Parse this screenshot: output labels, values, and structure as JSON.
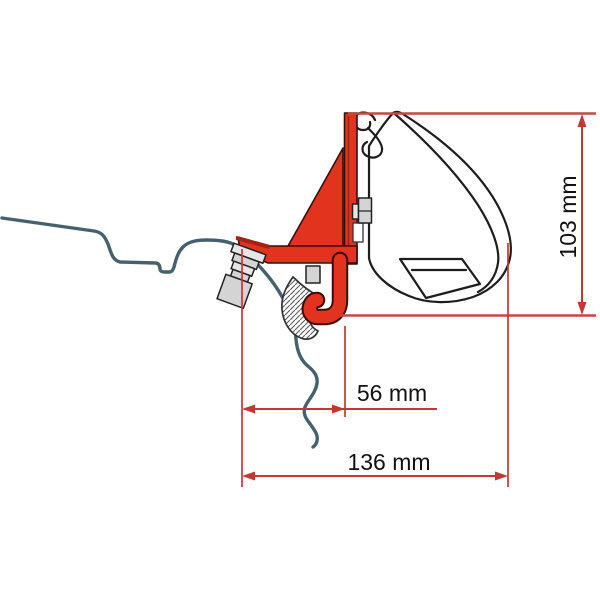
{
  "diagram": {
    "type": "awning-adapter-bracket-dimension-drawing",
    "dimension_labels": {
      "height": "103 mm",
      "bracket_offset": "56 mm",
      "total_depth": "136 mm"
    },
    "units": "mm",
    "colors": {
      "bracket_red": "#e2331f",
      "bracket_red_shade": "#a32317",
      "dimension_red": "#c13a32",
      "roof_profile_line": "#46616d",
      "outline_dark": "#1d1d1d",
      "metal_gray": "#d4d4d4",
      "background": "#ffffff"
    }
  }
}
